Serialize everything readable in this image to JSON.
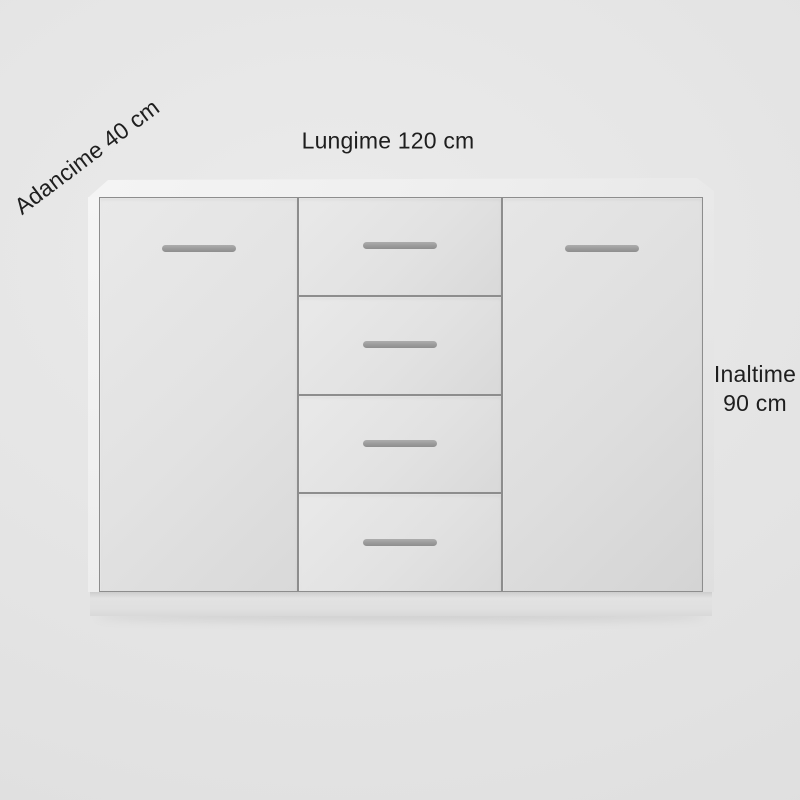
{
  "page": {
    "background": "#e3e3e3",
    "text_color": "#1e1e1e"
  },
  "annotations": {
    "depth": "Adancime 40 cm",
    "length": "Lungime 120 cm",
    "height_lines": [
      "Inaltime",
      "90 cm"
    ]
  },
  "furniture": {
    "type": "sideboard",
    "door_count": 2,
    "drawer_count": 4,
    "colors": {
      "panel": "#e2e2e2",
      "top": "#efefef",
      "outline": "#8d8d8d",
      "handle": "#969696",
      "base": "#e2e2e2"
    }
  }
}
